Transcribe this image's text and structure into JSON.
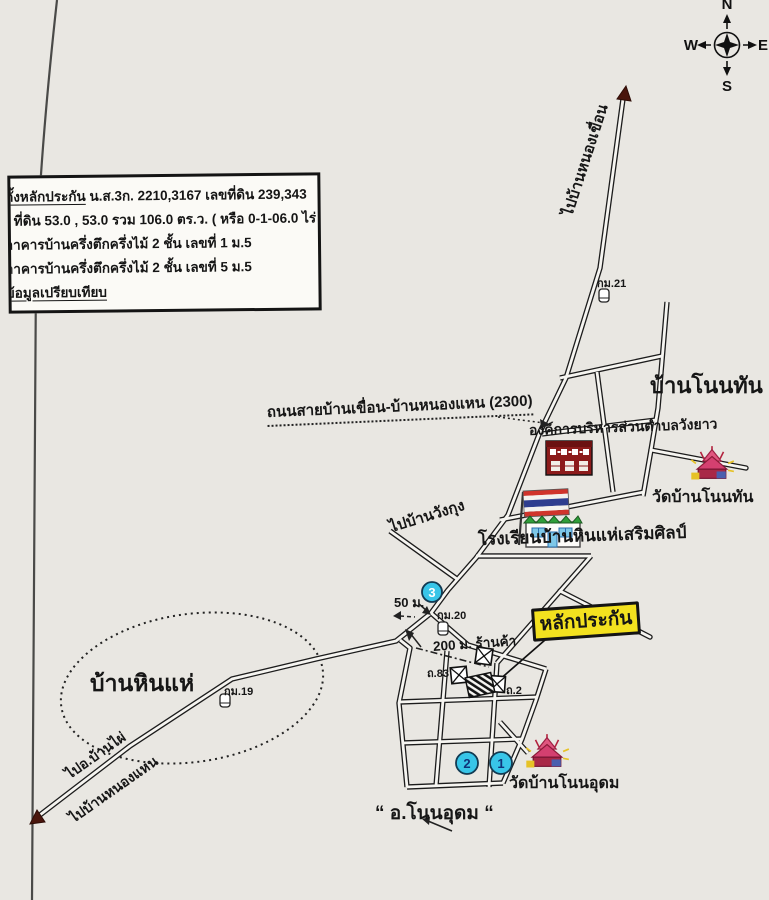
{
  "compass": {
    "north": "N",
    "east": "E",
    "south": "S",
    "west": "W"
  },
  "info_box": {
    "line1_head": "ตั้งหลักประกัน",
    "line1_rest": " น.ส.3ก. 2210,3167  เลขที่ดิน 239,343",
    "line2": "ที่ดิน 53.0 , 53.0 รวม 106.0 ตร.ว. ( หรือ 0-1-06.0 ไร่ )",
    "line3": "อาคารบ้านครึ่งตึกครึ่งไม้ 2 ชั้น เลขที่ 1 ม.5",
    "line4": "อาคารบ้านครึ่งตึกครึ่งไม้ 2 ชั้น เลขที่ 5 ม.5",
    "line5": "ข้อมูลเปรียบเทียบ"
  },
  "roads": {
    "highway_label": "ถนนสายบ้านเขื่อน-บ้านหนองแหน (2300)",
    "to_nong_khuean": "ไปบ้านหนองเขื่อน",
    "to_wang_kung": "ไปบ้านวังกุง",
    "to_ban_phai": "ไปอ.บ้านไผ่",
    "to_nong_haen": "ไปบ้านหนองแหน"
  },
  "places": {
    "ban_non_than": "บ้านโนนทัน “",
    "sao_wang_yao": "องค์การบริหารส่วนตำบลวังยาว",
    "wat_non_than": "วัดบ้านโนนทัน",
    "school": "โรงเรียนบ้านหินแห่เสริมศิลป์",
    "ban_hin_hae": "บ้านหินแห่",
    "wat_non_udom": "วัดบ้านโนนอุดม",
    "amphoe_non_udom": "“ อ.โนนอุดม “",
    "collateral": "หลักประกัน"
  },
  "markers": {
    "km19": "กม.19",
    "km20": "กม.20",
    "km21": "กม.21",
    "dist50": "50 ม.",
    "dist200": "200 ม.  ร้านค้า",
    "road83": "ถ.83",
    "road2": "ถ.2",
    "num1": "1",
    "num2": "2",
    "num3": "3"
  },
  "icons": {
    "compass": "compass-rose",
    "km_post": "kilometer-post",
    "shop": "crossed-box-building",
    "collateral_building": "hatched-building",
    "temple": "thai-temple",
    "school": "school-with-thai-flag",
    "sao_office": "government-office-building",
    "road_end": "dark-red-arrowhead"
  },
  "colors": {
    "paper": "#e9e7e2",
    "collateral_bg": "#f3e11f",
    "marker_circle": "#38c5e8",
    "marker_number": "#10327a",
    "arrow_red": "#4a150c",
    "temple_pink": "#d44070",
    "flag_red": "#d0342c",
    "flag_blue": "#2f3e8f",
    "school_roof": "#2f9e3a",
    "sao_building": "#8c1b1b"
  }
}
